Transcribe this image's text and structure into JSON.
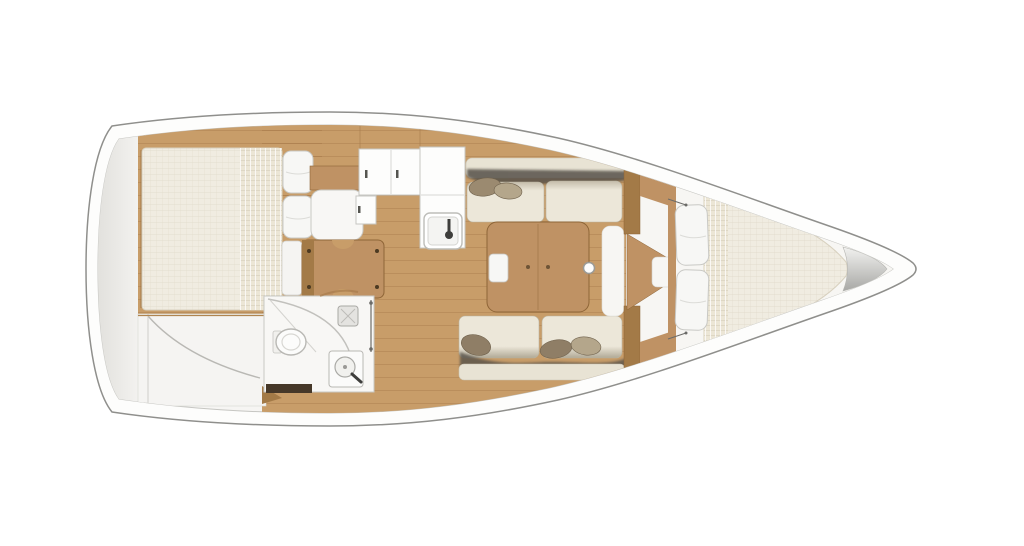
{
  "diagram": {
    "kind": "sailboat-interior-floor-plan",
    "orientation": "bow-right",
    "rooms": [
      {
        "id": "aft-cabin",
        "desc": "aft double berth with blanket and pillows, port side"
      },
      {
        "id": "sail-locker",
        "desc": "aft storage locker with curved panel line"
      },
      {
        "id": "nav-station",
        "desc": "chart table with seat facing aft"
      },
      {
        "id": "galley",
        "desc": "L-shaped galley with counters and sink"
      },
      {
        "id": "head",
        "desc": "bathroom with toilet, shower and washbasin"
      },
      {
        "id": "salon",
        "desc": "two facing settees with throw pillows and folding table"
      },
      {
        "id": "forward-cabin",
        "desc": "V-berth with two pillows and blanket strip"
      },
      {
        "id": "anchor-locker",
        "desc": "grey cone locker at bow tip"
      }
    ]
  },
  "colors": {
    "background": "#ffffff",
    "hull_deck": "#fdfdfc",
    "hull_outline": "#8f8f8c",
    "deck_inner": "#f6f5f3",
    "deck_inner_line": "#c6c6c2",
    "stern_shade": "#e2e1dd",
    "wood_floor": "#c89d69",
    "wood_seam": "#a87c4c",
    "wood_furniture": "#bf9264",
    "wood_dark": "#a37a47",
    "wood_outline": "#8e6537",
    "mattress": "#f0ece1",
    "mattress_line": "#d8d1bf",
    "blanket": "#ece6d5",
    "pillow": "#f7f7f5",
    "pillow_line": "#c9c9c5",
    "cushion": "#ece7d9",
    "cushion_shade": "#b1a996",
    "shadow_band": "#57514a",
    "throw_dark": "#8f7e66",
    "throw_mid": "#9b8a70",
    "throw_light": "#b4a68b",
    "fixture_white": "#f8f7f5",
    "fixture_line": "#b9b8b4",
    "metal_dark": "#3e3e3c",
    "head_floor": "#463829",
    "walkway_white": "#f7f6f3",
    "storage_panel": "#f5f4f2",
    "cone_light": "#f2f2f0",
    "cone_dark": "#a8a8a5"
  }
}
